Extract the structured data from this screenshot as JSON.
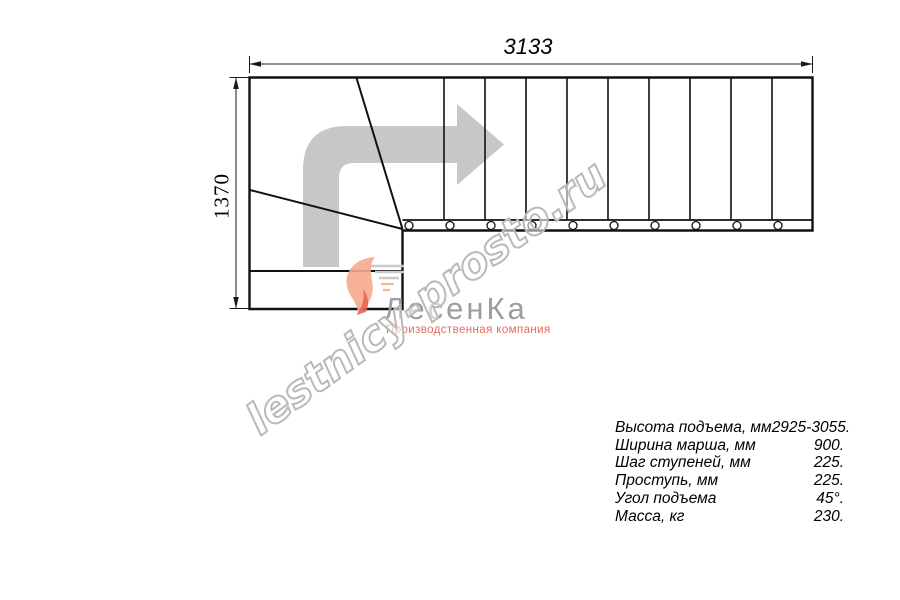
{
  "drawing": {
    "width_label": "3133",
    "height_label": "1370"
  },
  "watermark": {
    "text": "lestnicy-prosto.ru"
  },
  "logo": {
    "name": "ЛесенКа",
    "tagline": "Производственная компания"
  },
  "specs": {
    "rows": [
      {
        "label": "Высота подъема, мм",
        "value": "2925-3055."
      },
      {
        "label": "Ширина марша, мм",
        "value": "900."
      },
      {
        "label": "Шаг ступеней, мм",
        "value": "225."
      },
      {
        "label": "Проступь, мм",
        "value": "225."
      },
      {
        "label": "Угол подъема",
        "value": "45°."
      },
      {
        "label": "Масса, кг",
        "value": "230."
      }
    ]
  },
  "colors": {
    "line": "#111111",
    "dimension_line": "#1a1a1a",
    "direction_arrow": "#c7c7c7",
    "watermark_outline": "#b9b9b9",
    "logo_gray": "#9d9d9d",
    "logo_red": "#e66a5e"
  }
}
